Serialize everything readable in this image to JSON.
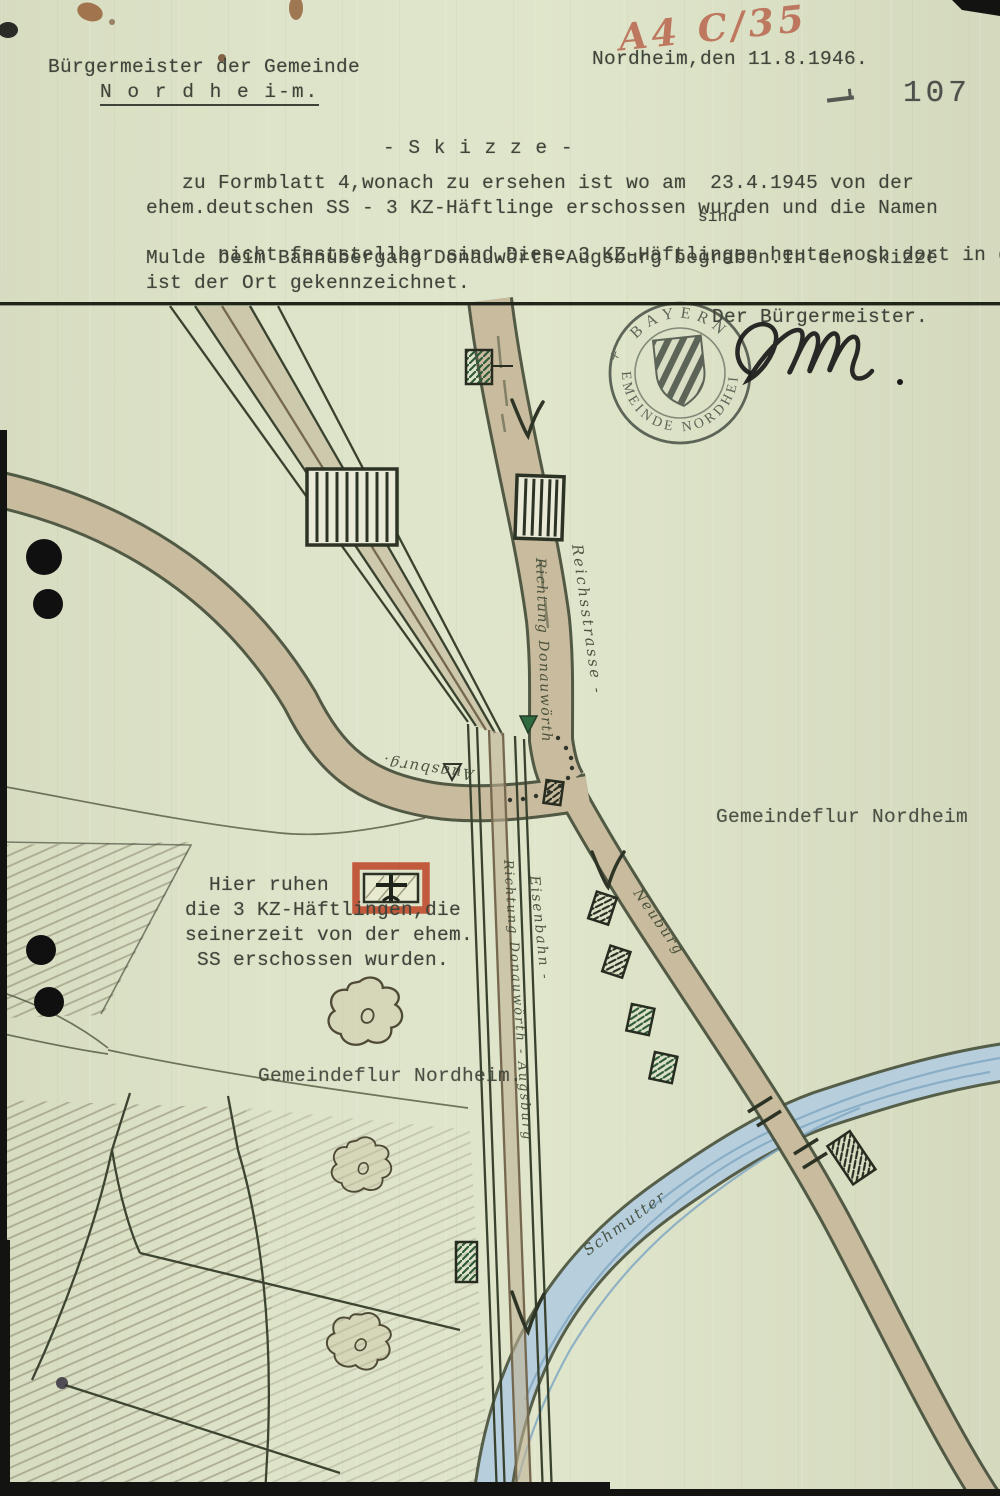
{
  "page": {
    "number_stamp": "107",
    "red_annotation": "A4 C/35"
  },
  "header": {
    "sender_line1": "Bürgermeister der Gemeinde",
    "sender_line2": "N o r d h e i-m.",
    "dateline": "Nordheim,den 11.8.1946."
  },
  "title": "- S k i z z e -",
  "body": {
    "line1": "   zu Formblatt 4,wonach zu ersehen ist wo am  23.4.1945 von der",
    "line2": "ehem.deutschen SS - 3 KZ-Häftlinge erschossen wurden und die Namen",
    "line3": "nicht feststellbar sind.Diese 3 KZ-Häftlingen heute noch dort in der",
    "line3_insert": "sind",
    "line4": "Mulde beim Bahnübergang Donauwörth-Augsburg begraben.In der Skizze",
    "line5": "ist der Ort gekennzeichnet."
  },
  "signature_block": {
    "role": "Der Bürgermeister."
  },
  "stamp": {
    "top_text": "BAYERN",
    "bottom_text": "GEMEINDE NORDHEIM",
    "side_mark": "x"
  },
  "map": {
    "labels": {
      "reichsstrasse": "Reichsstrasse -",
      "richtung_donauwoerth": "Richtung Donauwörth",
      "augsburg": "Augsburg.",
      "eisenbahn": "Eisenbahn -",
      "railway_direction": "Richtung Donauwörth - Augsburg",
      "neuburg": "Neuburg",
      "river": "Schmutter",
      "flur_right": "Gemeindeflur Nordheim",
      "flur_left": "Gemeindeflur Nordheim."
    },
    "grave_note": {
      "line1": "  Hier ruhen",
      "line2": "die 3 KZ-Häftlingen,die",
      "line3": "seinerzeit von der ehem.",
      "line4": " SS erschossen wurden."
    }
  }
}
